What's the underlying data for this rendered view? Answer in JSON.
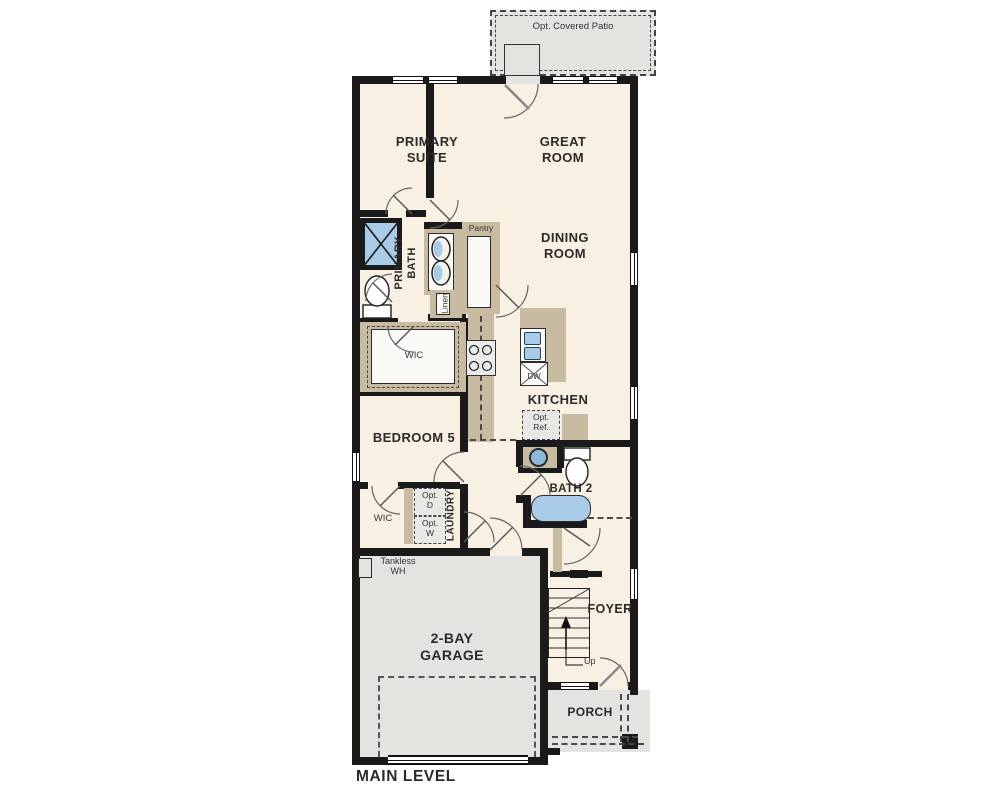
{
  "title": "MAIN LEVEL",
  "colors": {
    "floor": "#f8f0e2",
    "concrete": "#e4e3e0",
    "cabinet": "#c9bba1",
    "fixture_blue": "#a9cbe8",
    "wall": "#1a1a1a"
  },
  "rooms": {
    "patio": {
      "label": "Opt. Covered Patio"
    },
    "primary_suite": {
      "line1": "PRIMARY",
      "line2": "SUITE"
    },
    "great_room": {
      "line1": "GREAT",
      "line2": "ROOM"
    },
    "dining_room": {
      "line1": "DINING",
      "line2": "ROOM"
    },
    "primary_bath": {
      "line1": "PRIMARY",
      "line2": "BATH"
    },
    "pantry": {
      "label": "Pantry"
    },
    "linen": {
      "label": "Linen"
    },
    "wic_primary": {
      "label": "WIC"
    },
    "kitchen": {
      "label": "KITCHEN"
    },
    "bedroom5": {
      "label": "BEDROOM 5"
    },
    "bath2": {
      "label": "BATH 2"
    },
    "laundry": {
      "label": "LAUNDRY"
    },
    "wic_bedroom5": {
      "label": "WIC"
    },
    "garage": {
      "line1": "2-BAY",
      "line2": "GARAGE"
    },
    "foyer": {
      "label": "FOYER"
    },
    "porch": {
      "label": "PORCH"
    }
  },
  "fixtures": {
    "dishwasher": "DW",
    "opt_ref": {
      "line1": "Opt.",
      "line2": "Ref."
    },
    "opt_dryer": {
      "line1": "Opt.",
      "line2": "D"
    },
    "opt_washer": {
      "line1": "Opt.",
      "line2": "W"
    },
    "tankless": {
      "line1": "Tankless",
      "line2": "WH"
    },
    "stairs_up": "Up"
  }
}
